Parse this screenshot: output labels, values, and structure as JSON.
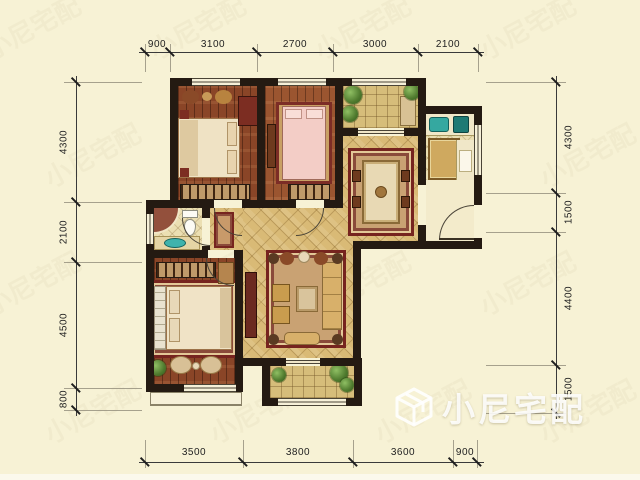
{
  "title": "apartment-floor-plan",
  "background_color": "#f7f2d5",
  "wall_color": "#241a12",
  "dimensions_mm": {
    "top": [
      "900",
      "3100",
      "2700",
      "3000",
      "2100"
    ],
    "bottom": [
      "3500",
      "3800",
      "3600",
      "900"
    ],
    "left": [
      "4300",
      "2100",
      "4500",
      "800"
    ],
    "right": [
      "4300",
      "1500",
      "4400",
      "1500"
    ]
  },
  "watermark": {
    "brand": "小尼宅配",
    "logo": "cube-outline-icon"
  },
  "palette": {
    "wood_floor": "#8a4527",
    "gold_tile": "#d9ba76",
    "pale_tile": "#ebdfb2",
    "rug_maroon": "#76241f",
    "plant_green": "#4f7a2e",
    "fixture_teal": "#35a8a0"
  }
}
